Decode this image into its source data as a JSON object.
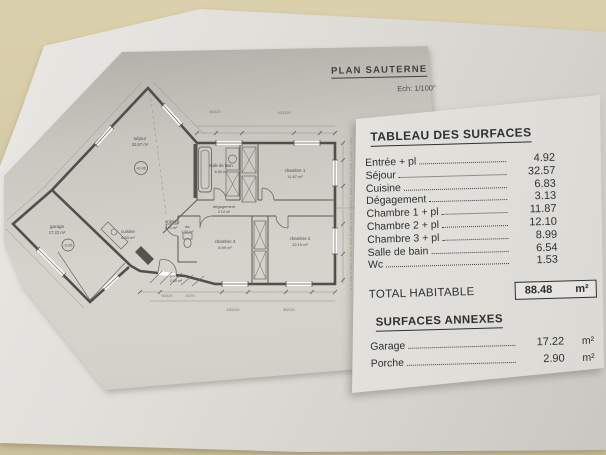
{
  "title_block": {
    "title": "PLAN SAUTERNE",
    "scale": "Ech: 1/100°"
  },
  "surfaces_table": {
    "title": "TABLEAU DES SURFACES",
    "rows": [
      {
        "label": "Entrée + pl",
        "value": "4.92"
      },
      {
        "label": "Séjour",
        "value": "32.57"
      },
      {
        "label": "Cuisine",
        "value": "6.83"
      },
      {
        "label": "Dégagement",
        "value": "3.13"
      },
      {
        "label": "Chambre 1 + pl",
        "value": "11.87"
      },
      {
        "label": "Chambre 2 + pl",
        "value": "12.10"
      },
      {
        "label": "Chambre 3 + pl",
        "value": "8.99"
      },
      {
        "label": "Salle de bain",
        "value": "6.54"
      },
      {
        "label": "Wc",
        "value": "1.53"
      }
    ],
    "total": {
      "label": "TOTAL HABITABLE",
      "value": "88.48",
      "unit": "m²"
    },
    "annex_title": "SURFACES ANNEXES",
    "annex_rows": [
      {
        "label": "Garage",
        "value": "17.22",
        "unit": "m²"
      },
      {
        "label": "Porche",
        "value": "2.90",
        "unit": "m²"
      }
    ]
  },
  "plan": {
    "rooms": {
      "sejour": {
        "label": "séjour",
        "area": "32.57 m²"
      },
      "garage": {
        "label": "garage",
        "area": "17.22 m²"
      },
      "cuisine": {
        "label": "cuisine",
        "area": "6.83 m²"
      },
      "entree": {
        "label": "entrée",
        "area": "4.92 m²"
      },
      "wc": {
        "label": "wc",
        "area": "1.53 m²"
      },
      "porche": {
        "label": "porche",
        "area": "2.90 m²"
      },
      "salle_de_bain": {
        "label": "salle de bain",
        "area": "6.54 m²"
      },
      "degagement": {
        "label": "dégagement",
        "area": "3.13 m²"
      },
      "chambre1": {
        "label": "chambre 1",
        "area": "11.87 m²"
      },
      "chambre2": {
        "label": "chambre 2",
        "area": "12.10 m²"
      },
      "chambre3": {
        "label": "chambre 3",
        "area": "8.99 m²"
      }
    },
    "levels": {
      "main": "+0.00",
      "garage": "-0.05"
    },
    "dims": [
      "80/120",
      "100/120",
      "90/120",
      "40/75",
      "120/120",
      "80/120"
    ]
  },
  "colors": {
    "table_bg": "#d6cba8",
    "paper": "#dedcd7",
    "plan_sheet": "#c9c6c0",
    "ink": "#2e3034"
  }
}
